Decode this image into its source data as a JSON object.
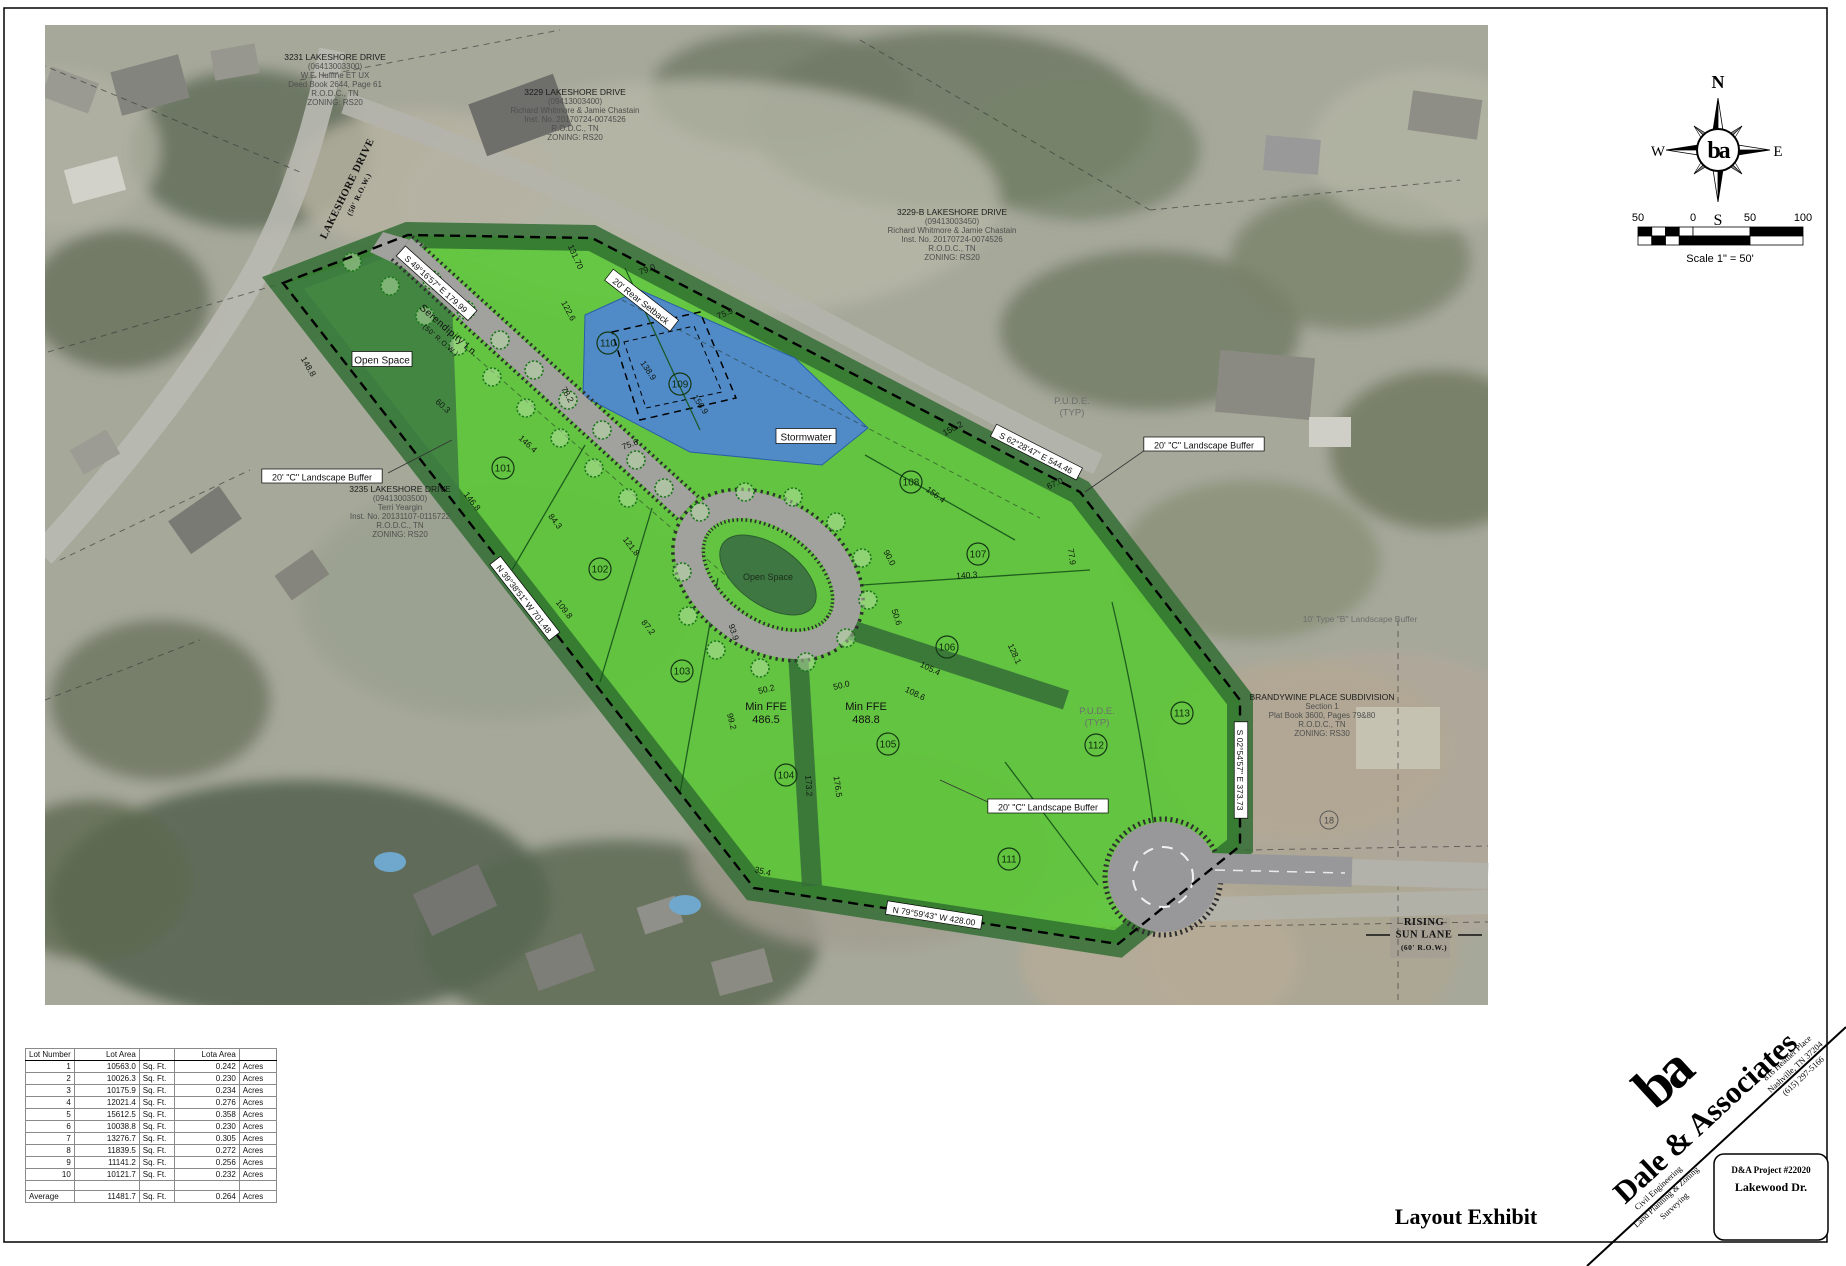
{
  "sheet": {
    "title": "Layout Exhibit",
    "compass": {
      "north": "N",
      "south": "S",
      "east": "E",
      "west": "W",
      "logo": "ba"
    },
    "scale_bar": {
      "tick_labels": [
        "50",
        "0",
        "50",
        "100"
      ],
      "caption": "Scale 1\" = 50'"
    }
  },
  "palette": {
    "lot_green": "#54cb2d",
    "buffer_green": "#2c6a2e",
    "open_space_green": "#3f7d42",
    "stormwater_blue": "#4e86d4",
    "road_gray": "#a1a19d",
    "tree_green": "#1d7a1d"
  },
  "lot_table": {
    "headers": [
      "Lot Number",
      "Lot Area",
      "",
      "Lota Area",
      ""
    ],
    "rows": [
      [
        "1",
        "10563.0",
        "Sq. Ft.",
        "0.242",
        "Acres"
      ],
      [
        "2",
        "10026.3",
        "Sq. Ft.",
        "0.230",
        "Acres"
      ],
      [
        "3",
        "10175.9",
        "Sq. Ft.",
        "0.234",
        "Acres"
      ],
      [
        "4",
        "12021.4",
        "Sq. Ft.",
        "0.276",
        "Acres"
      ],
      [
        "5",
        "15612.5",
        "Sq. Ft.",
        "0.358",
        "Acres"
      ],
      [
        "6",
        "10038.8",
        "Sq. Ft.",
        "0.230",
        "Acres"
      ],
      [
        "7",
        "13276.7",
        "Sq. Ft.",
        "0.305",
        "Acres"
      ],
      [
        "8",
        "11839.5",
        "Sq. Ft.",
        "0.272",
        "Acres"
      ],
      [
        "9",
        "11141.2",
        "Sq. Ft.",
        "0.256",
        "Acres"
      ],
      [
        "10",
        "10121.7",
        "Sq. Ft.",
        "0.232",
        "Acres"
      ]
    ],
    "average_row": [
      "Average",
      "11481.7",
      "Sq. Ft.",
      "0.264",
      "Acres"
    ]
  },
  "firm": {
    "name": "Dale & Associates",
    "logo": "ba",
    "address_lines": [
      "816 Heather Place",
      "Nashville, TN 37204",
      "(615) 297-5166"
    ],
    "service_lines": [
      "Civil Engineering",
      "Land Planning & Zoning",
      "Surveying"
    ],
    "project_number": "D&A Project #22020",
    "project_name": "Lakewood Dr."
  },
  "plan": {
    "lots": [
      {
        "n": "101",
        "x": 503,
        "y": 468
      },
      {
        "n": "102",
        "x": 600,
        "y": 569
      },
      {
        "n": "103",
        "x": 682,
        "y": 671
      },
      {
        "n": "104",
        "x": 786,
        "y": 775
      },
      {
        "n": "105",
        "x": 888,
        "y": 744
      },
      {
        "n": "106",
        "x": 947,
        "y": 647
      },
      {
        "n": "107",
        "x": 978,
        "y": 554
      },
      {
        "n": "108",
        "x": 911,
        "y": 482
      },
      {
        "n": "109",
        "x": 680,
        "y": 384
      },
      {
        "n": "110",
        "x": 608,
        "y": 343
      },
      {
        "n": "111",
        "x": 1009,
        "y": 859
      },
      {
        "n": "112",
        "x": 1096,
        "y": 745
      },
      {
        "n": "113",
        "x": 1182,
        "y": 713
      }
    ],
    "dimensions": [
      {
        "t": "79.0",
        "x": 648,
        "y": 272,
        "r": -20
      },
      {
        "t": "75.9",
        "x": 726,
        "y": 316,
        "r": -22
      },
      {
        "t": "122.6",
        "x": 566,
        "y": 312,
        "r": 62
      },
      {
        "t": "138.9",
        "x": 646,
        "y": 372,
        "r": 56
      },
      {
        "t": "156.9",
        "x": 698,
        "y": 406,
        "r": 56
      },
      {
        "t": "78.2",
        "x": 565,
        "y": 396,
        "r": 60
      },
      {
        "t": "75.6",
        "x": 631,
        "y": 447,
        "r": -20
      },
      {
        "t": "131.70",
        "x": 573,
        "y": 258,
        "r": 66
      },
      {
        "t": "146.4",
        "x": 526,
        "y": 446,
        "r": 42
      },
      {
        "t": "60.3",
        "x": 441,
        "y": 408,
        "r": 42
      },
      {
        "t": "148.8",
        "x": 306,
        "y": 368,
        "r": 60
      },
      {
        "t": "146.8",
        "x": 470,
        "y": 503,
        "r": 52
      },
      {
        "t": "84.3",
        "x": 553,
        "y": 523,
        "r": 52
      },
      {
        "t": "121.8",
        "x": 629,
        "y": 548,
        "r": 52
      },
      {
        "t": "109.8",
        "x": 562,
        "y": 611,
        "r": 52
      },
      {
        "t": "87.2",
        "x": 646,
        "y": 629,
        "r": 52
      },
      {
        "t": "93.9",
        "x": 731,
        "y": 633,
        "r": 72
      },
      {
        "t": "50.2",
        "x": 767,
        "y": 692,
        "r": -14
      },
      {
        "t": "50.0",
        "x": 842,
        "y": 688,
        "r": -14
      },
      {
        "t": "99.2",
        "x": 729,
        "y": 722,
        "r": 76
      },
      {
        "t": "173.2",
        "x": 806,
        "y": 786,
        "r": 86
      },
      {
        "t": "176.5",
        "x": 835,
        "y": 787,
        "r": 82
      },
      {
        "t": "150.2",
        "x": 954,
        "y": 431,
        "r": -28
      },
      {
        "t": "67.0",
        "x": 1056,
        "y": 486,
        "r": -24
      },
      {
        "t": "156.4",
        "x": 934,
        "y": 497,
        "r": 36
      },
      {
        "t": "140.3",
        "x": 967,
        "y": 578,
        "r": -4
      },
      {
        "t": "77.9",
        "x": 1069,
        "y": 557,
        "r": 82
      },
      {
        "t": "90.0",
        "x": 887,
        "y": 559,
        "r": 62
      },
      {
        "t": "50.6",
        "x": 894,
        "y": 618,
        "r": 72
      },
      {
        "t": "105.4",
        "x": 929,
        "y": 671,
        "r": 26
      },
      {
        "t": "108.6",
        "x": 914,
        "y": 696,
        "r": 26
      },
      {
        "t": "128.1",
        "x": 1012,
        "y": 655,
        "r": 66
      },
      {
        "t": "35.4",
        "x": 762,
        "y": 874,
        "r": 14
      }
    ],
    "bearings": [
      {
        "t": "S 49°16'57\" E 179.99",
        "x": 436,
        "y": 284,
        "r": 42
      },
      {
        "t": "S 62°28'47\" E 544.46",
        "x": 1036,
        "y": 453,
        "r": 27
      },
      {
        "t": "N 39°38'51\" W 701.48",
        "x": 524,
        "y": 599,
        "r": 52
      },
      {
        "t": "S 02°54'57\" E 373.73",
        "x": 1240,
        "y": 770,
        "r": 90
      },
      {
        "t": "N 79°59'43\" W 428.00",
        "x": 934,
        "y": 916,
        "r": 9
      }
    ],
    "box_labels": [
      {
        "t": "20' \"C\" Landscape Buffer",
        "x": 322,
        "y": 477,
        "r": 0
      },
      {
        "t": "20' \"C\" Landscape Buffer",
        "x": 1204,
        "y": 445,
        "r": 0
      },
      {
        "t": "20' \"C\" Landscape Buffer",
        "x": 1048,
        "y": 807,
        "r": 0
      },
      {
        "t": "20' Rear Setback",
        "x": 641,
        "y": 301,
        "r": 38
      }
    ],
    "area_labels": [
      {
        "lines": [
          "Open Space"
        ],
        "x": 382,
        "y": 360,
        "size": 10,
        "box": true
      },
      {
        "lines": [
          "Open Space"
        ],
        "x": 768,
        "y": 580,
        "size": 9,
        "fill": "#1d2b1d"
      },
      {
        "lines": [
          "Stormwater"
        ],
        "x": 806,
        "y": 437,
        "size": 10,
        "box": true
      },
      {
        "lines": [
          "Min FFE",
          "486.5"
        ],
        "x": 766,
        "y": 710,
        "size": 11
      },
      {
        "lines": [
          "Min FFE",
          "488.8"
        ],
        "x": 866,
        "y": 710,
        "size": 11
      },
      {
        "lines": [
          "P.U.D.E.",
          "(TYP)"
        ],
        "x": 1072,
        "y": 404,
        "size": 9.5,
        "fill": "#6e6e6e"
      },
      {
        "lines": [
          "P.U.D.E.",
          "(TYP)"
        ],
        "x": 1097,
        "y": 714,
        "size": 9.5,
        "fill": "#6e6e6e"
      },
      {
        "lines": [
          "10' Type \"B\" Landscape Buffer"
        ],
        "x": 1360,
        "y": 622,
        "size": 8.5,
        "fill": "#6e6e6e"
      }
    ],
    "street_labels": [
      {
        "lines": [
          "LAKESHORE DRIVE",
          "(50' R.O.W.)"
        ],
        "x": 350,
        "y": 190,
        "r": -64,
        "serif": true,
        "size": 10.5,
        "sub": 7.5
      },
      {
        "lines": [
          "Serendipity Ln.",
          "(50' R.O.W.)"
        ],
        "x": 447,
        "y": 333,
        "r": 41,
        "serif": false,
        "size": 10,
        "sub": 7
      },
      {
        "lines": [
          "RISING",
          "SUN LANE",
          "(60' R.O.W.)"
        ],
        "x": 1424,
        "y": 925,
        "r": 0,
        "serif": true,
        "size": 10.5,
        "sub": 7.5
      }
    ],
    "neighbors": [
      {
        "x": 335,
        "y": 60,
        "lines": [
          "3231 LAKESHORE DRIVE",
          "(06413003300)",
          "W.F. Huffine ET UX",
          "Deed Book 2644, Page 61",
          "R.O.D.C., TN",
          "ZONING: RS20"
        ]
      },
      {
        "x": 575,
        "y": 95,
        "lines": [
          "3229 LAKESHORE DRIVE",
          "(09413003400)",
          "Richard Whitmore & Jamie Chastain",
          "Inst. No. 20170724-0074526",
          "R.O.D.C., TN",
          "ZONING: RS20"
        ]
      },
      {
        "x": 952,
        "y": 215,
        "lines": [
          "3229-B LAKESHORE DRIVE",
          "(09413003450)",
          "Richard Whitmore & Jamie Chastain",
          "Inst. No. 20170724-0074526",
          "R.O.D.C., TN",
          "ZONING: RS20"
        ]
      },
      {
        "x": 400,
        "y": 492,
        "lines": [
          "3235 LAKESHORE DRIVE",
          "(09413003500)",
          "Terri Yeargin",
          "Inst. No. 20131107-0115722",
          "R.O.D.C., TN",
          "ZONING: RS20"
        ]
      },
      {
        "x": 1322,
        "y": 700,
        "lines": [
          "BRANDYWINE PLACE SUBDIVISION",
          "Section 1",
          "Plat Book 3600, Pages 79&80",
          "R.O.D.C., TN",
          "ZONING: RS30"
        ]
      }
    ],
    "existing_lot_marker": "18"
  }
}
